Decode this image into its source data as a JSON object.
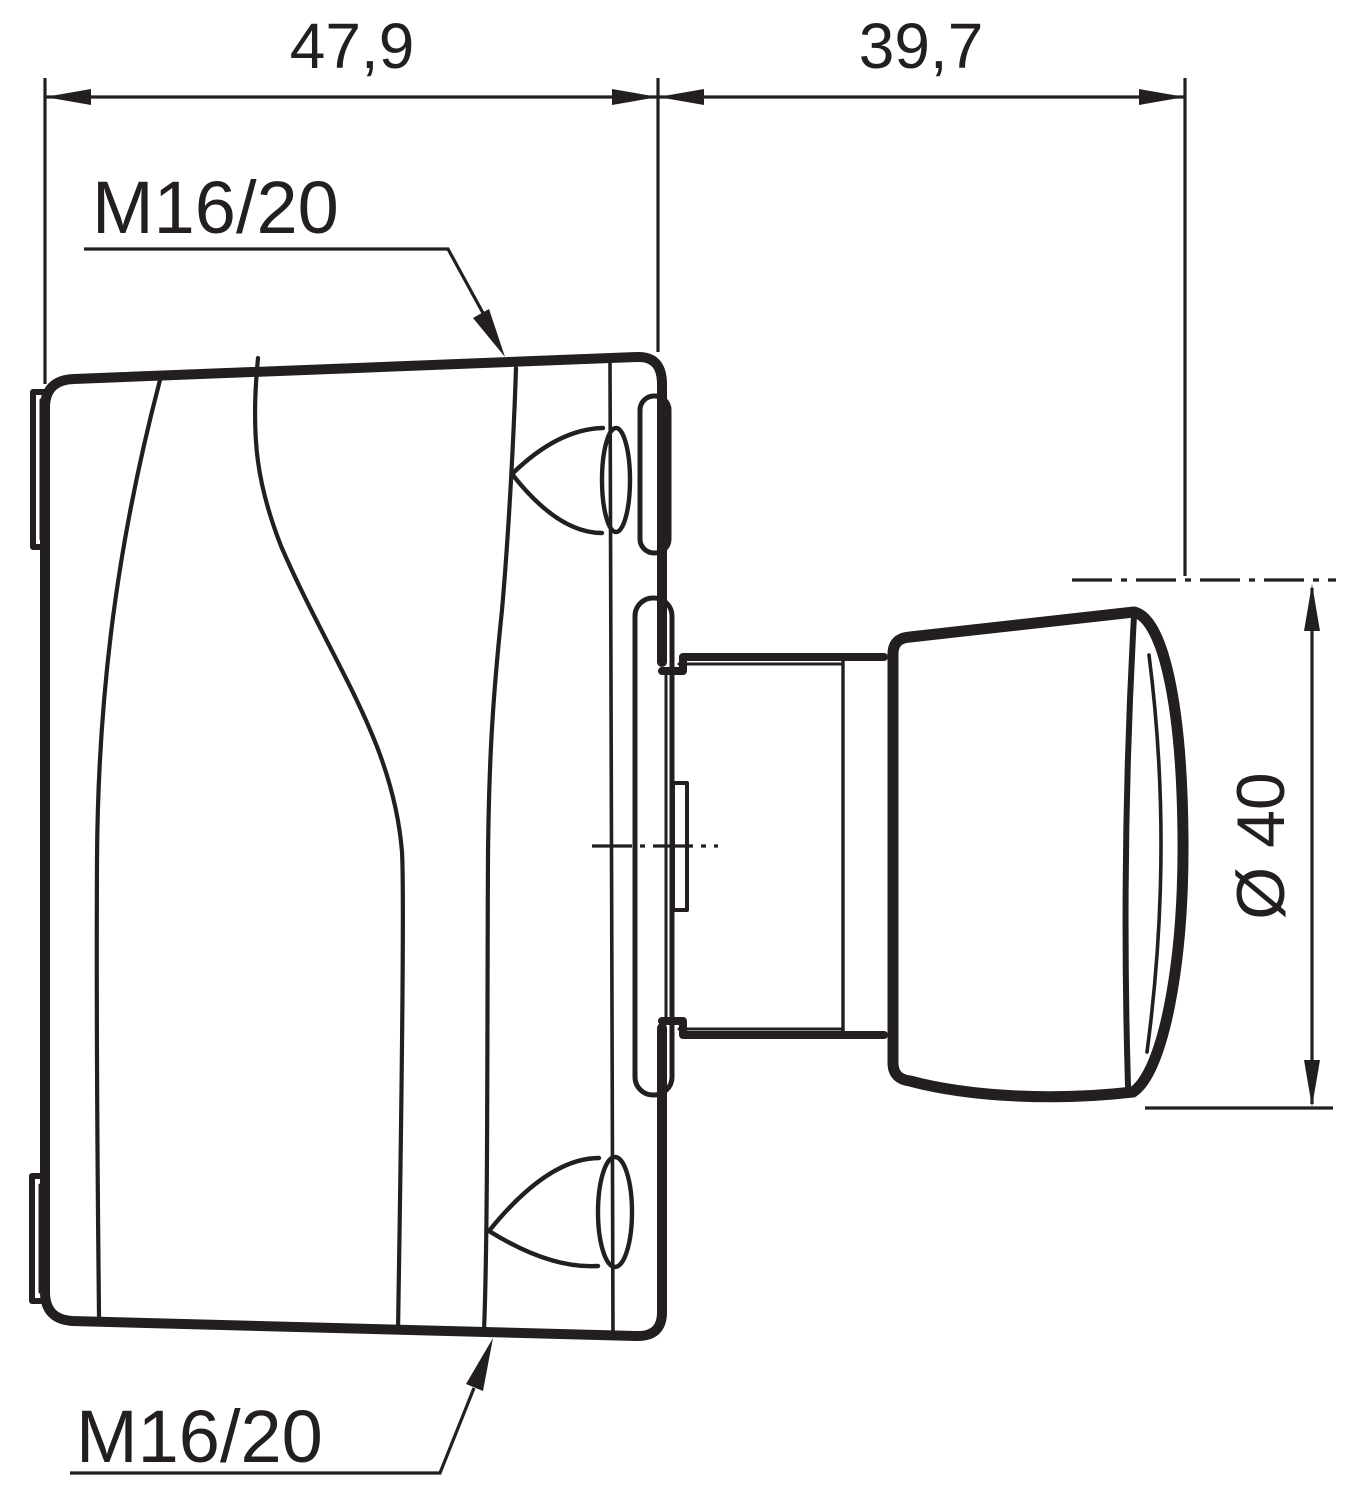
{
  "drawing": {
    "background": "#ffffff",
    "line_color": "#231f20",
    "dimensions": {
      "housing_width": "47,9",
      "button_depth": "39,7",
      "button_diameter": "Ø 40"
    },
    "cable_gland_labels": {
      "top": "M16/20",
      "bottom": "M16/20"
    }
  }
}
